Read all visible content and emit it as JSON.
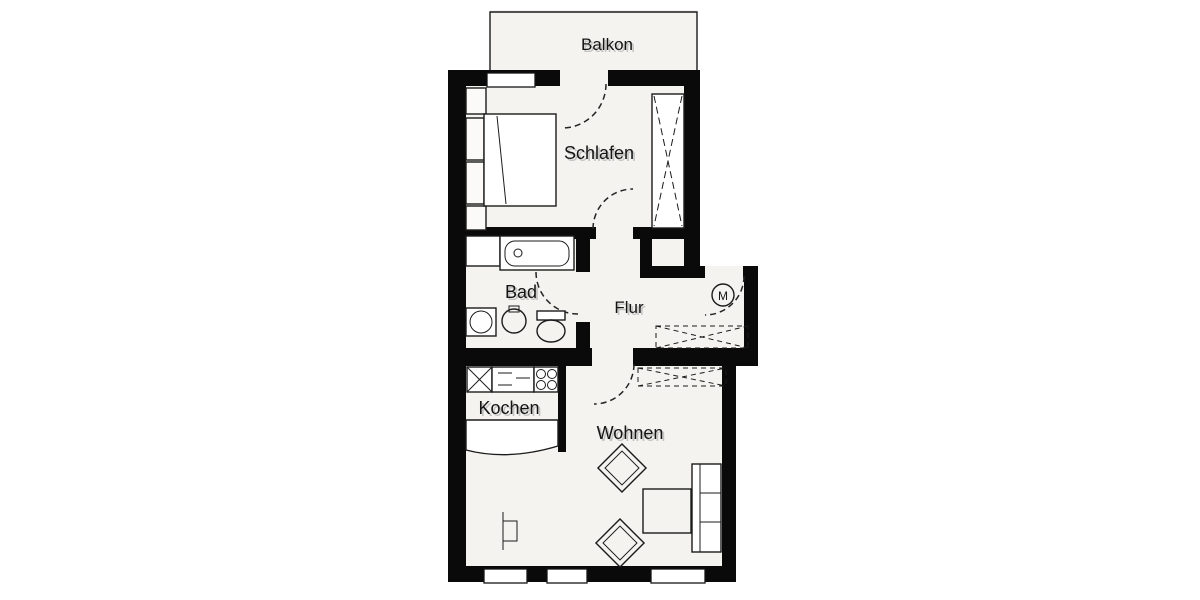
{
  "floorplan": {
    "rooms": {
      "balkon": {
        "label": "Balkon"
      },
      "schlafen": {
        "label": "Schlafen"
      },
      "bad": {
        "label": "Bad"
      },
      "flur": {
        "label": "Flur"
      },
      "kochen": {
        "label": "Kochen"
      },
      "wohnen": {
        "label": "Wohnen"
      }
    },
    "symbols": {
      "meter": "M"
    },
    "icons": [
      "bed-icon",
      "wardrobe-icon",
      "bathtub-icon",
      "washing-machine-icon",
      "washbasin-icon",
      "round-basin-icon",
      "toilet-icon",
      "meter-symbol-icon",
      "hall-cabinet-icon",
      "kitchen-sink-icon",
      "kitchen-counter-icon",
      "stove-icon",
      "kitchen-bar-icon",
      "sideboard-icon",
      "chair-icon",
      "table-icon",
      "sofa-icon",
      "floor-lamp-icon",
      "window-icon",
      "door-swing-icon"
    ],
    "colors": {
      "wall": "#0a0a0a",
      "floor": "#f4f3f0",
      "background": "#ffffff",
      "line": "#1b1b1b",
      "label_text": "#141414",
      "label_shadow": "#c3c3c3"
    }
  }
}
